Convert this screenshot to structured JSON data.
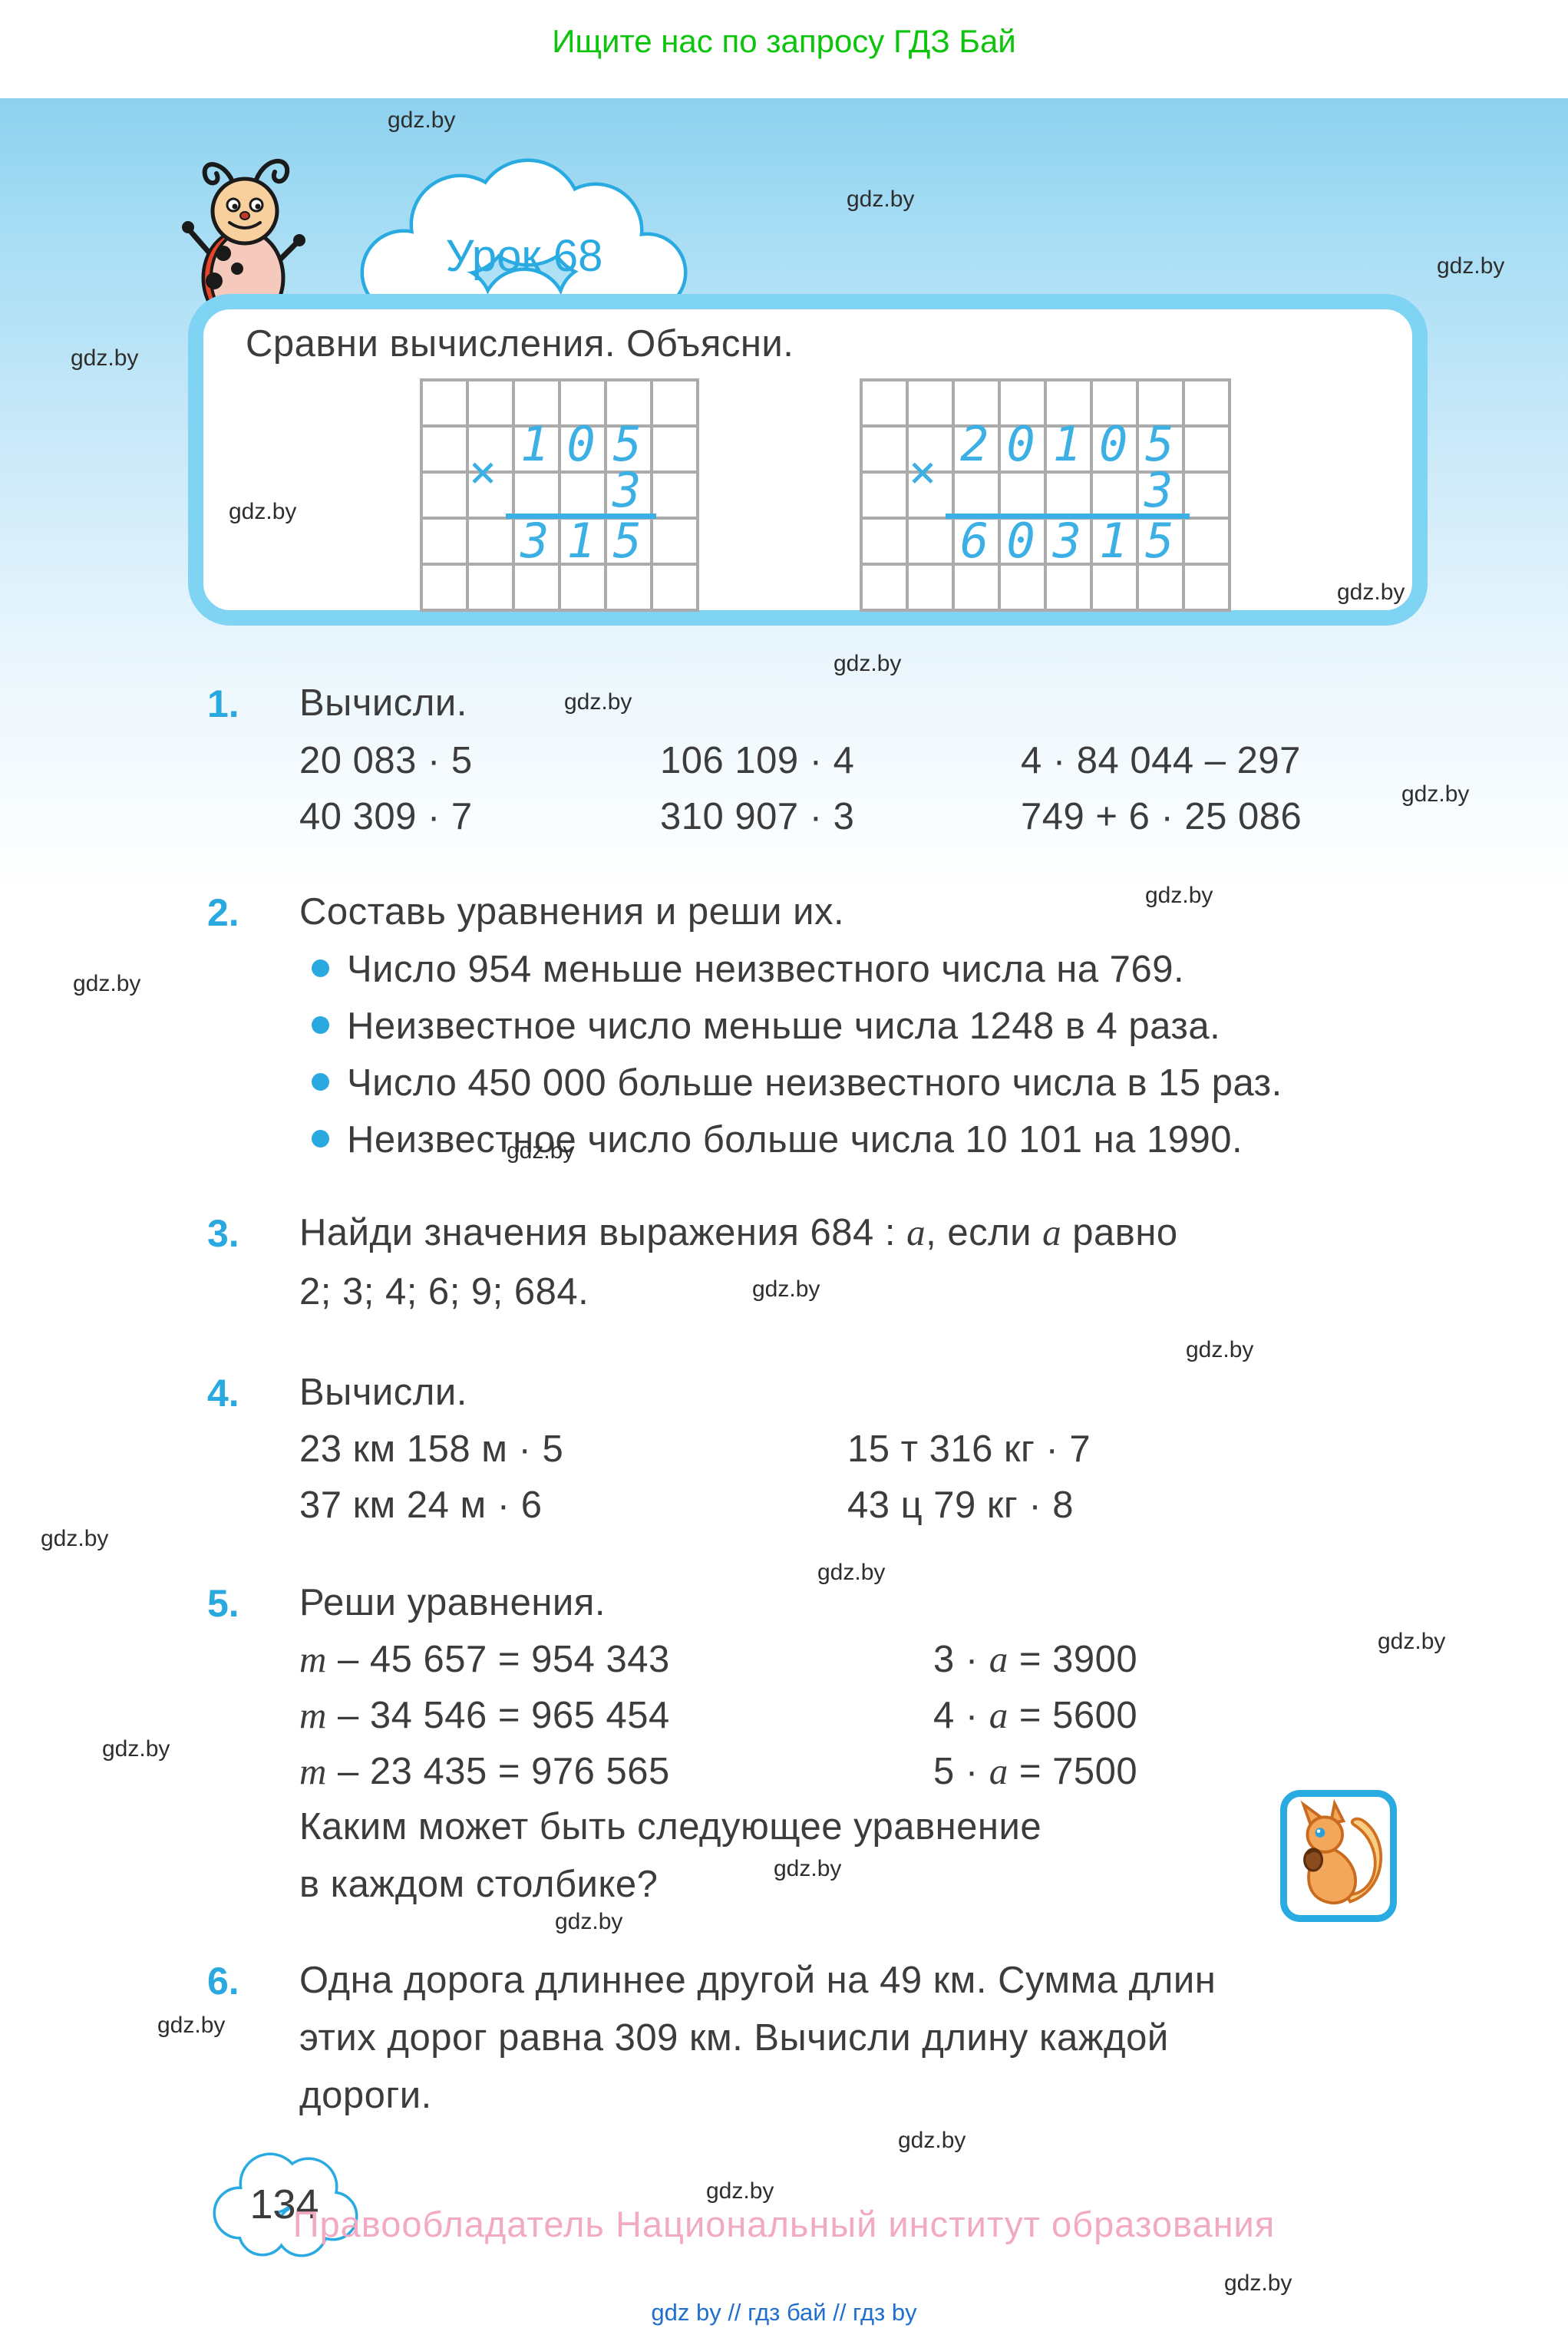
{
  "page": {
    "banner": "Ищите нас по запросу ГДЗ Бай",
    "watermark": "gdz.by",
    "lesson": "Урок 68",
    "page_number": "134",
    "copyright": "Правообладатель Национальный институт образования",
    "footer": "gdz by  //  гдз бай  //  гдз by"
  },
  "colors": {
    "accent_blue": "#29abe2",
    "handwriting_blue": "#3cb0e5",
    "banner_green": "#0bc40b",
    "copyright_pink": "#f2aac4",
    "box_border_blue": "#7fd3f3"
  },
  "intro": {
    "title": "Сравни вычисления. Объясни.",
    "sign": "×",
    "left_grid": {
      "top_number": "105",
      "multiplier": "3",
      "product": "315"
    },
    "right_grid": {
      "top_number": "20105",
      "multiplier": "3",
      "product": "60315"
    }
  },
  "ex1": {
    "num": "1.",
    "title": "Вычисли.",
    "r1c1": "20 083 · 5",
    "r1c2": "106 109 · 4",
    "r1c3": "4 · 84 044 – 297",
    "r2c1": "40 309 · 7",
    "r2c2": "310 907 · 3",
    "r2c3": "749 + 6 · 25 086"
  },
  "ex2": {
    "num": "2.",
    "title": "Составь уравнения и реши их.",
    "b1": "Число 954 меньше неизвестного числа на 769.",
    "b2": "Неизвестное число меньше числа 1248 в 4 раза.",
    "b3": "Число 450 000 больше неизвестного числа в 15 раз.",
    "b4": "Неизвестное число больше числа 10 101 на 1990."
  },
  "ex3": {
    "num": "3.",
    "t1": "Найди  значения  выражения  684 : ",
    "v1": "a",
    "t2": ",  если  ",
    "v2": "a",
    "t3": "  равно",
    "line2": "2; 3; 4; 6; 9; 684."
  },
  "ex4": {
    "num": "4.",
    "title": "Вычисли.",
    "r1c1": "23 км 158 м · 5",
    "r1c2": "15 т 316 кг · 7",
    "r2c1": "37 км 24 м · 6",
    "r2c2": "43 ц 79 кг · 8"
  },
  "ex5": {
    "num": "5.",
    "title": "Реши уравнения.",
    "l1v": "m",
    "l1": " – 45 657 = 954 343",
    "l2v": "m",
    "l2": " – 34 546 = 965 454",
    "l3v": "m",
    "l3": " – 23 435 = 976 565",
    "r1a": "3 · ",
    "r1v": "a",
    "r1b": " = 3900",
    "r2a": "4 · ",
    "r2v": "a",
    "r2b": " = 5600",
    "r3a": "5 · ",
    "r3v": "a",
    "r3b": " = 7500",
    "q1": "Каким может быть следующее уравнение",
    "q2": "в каждом столбике?"
  },
  "ex6": {
    "num": "6.",
    "l1": "Одна дорога длиннее другой на 49 км. Сумма длин",
    "l2": "этих дорог равна 309 км. Вычисли длину каждой",
    "l3": "дороги."
  }
}
